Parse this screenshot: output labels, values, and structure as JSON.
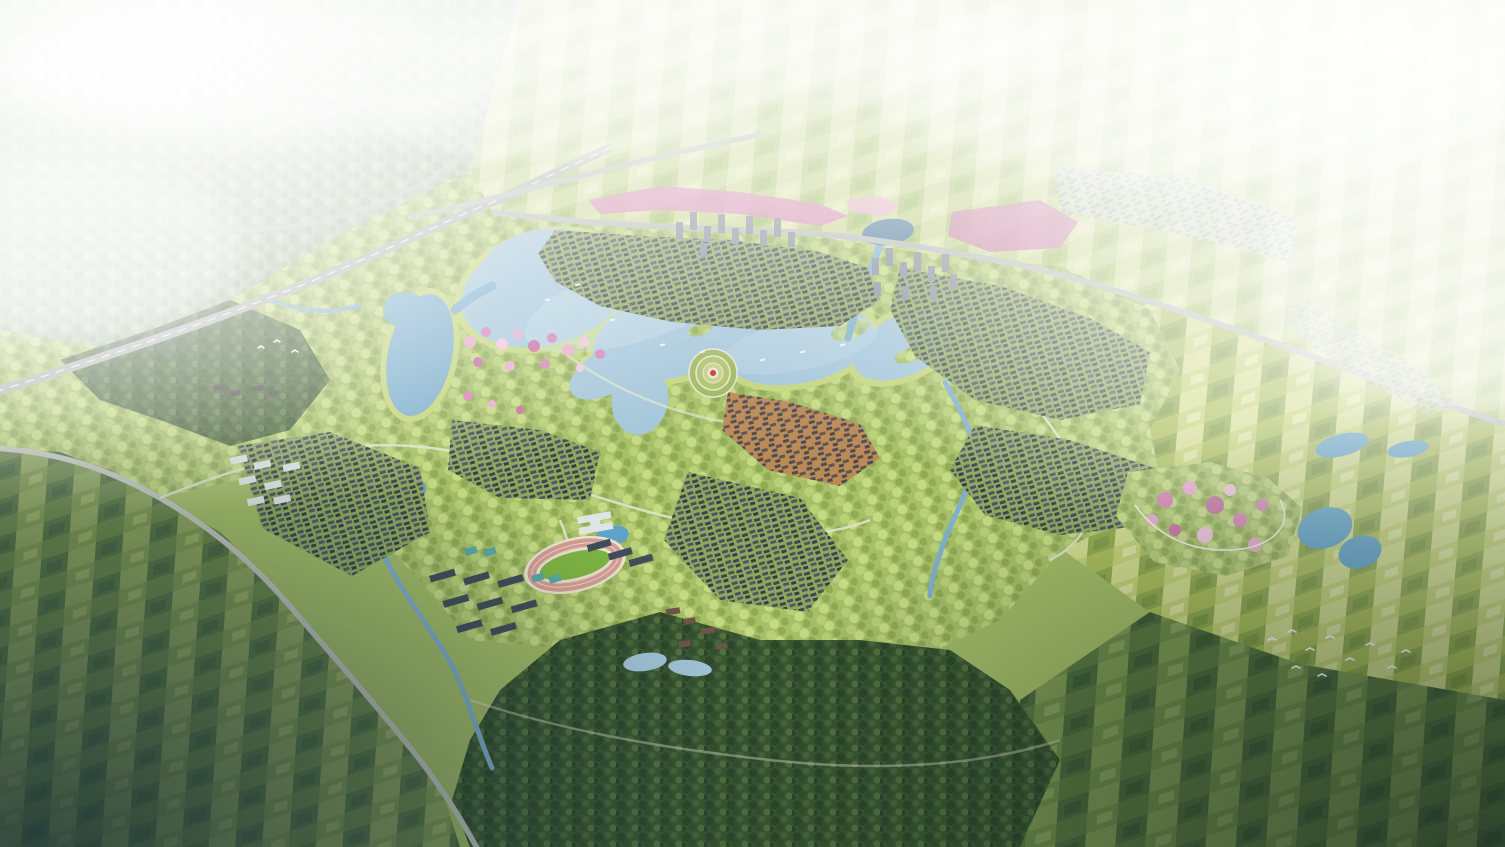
{
  "meta": {
    "description": "Photorealistic aerial bird's-eye rendering of a planned lakeside eco-town: central lake with circular plaza island, high-rise clusters on the north shore, low-rise villages, school campus with stadium, dark forest to the south, and hazy patchwork farmland all around. No text or UI elements are present in the image.",
    "width": 1505,
    "height": 847
  },
  "scene": {
    "features": [
      "misty northwest forest",
      "highway with loop-ramp interchange",
      "north boundary road",
      "western ring road",
      "central lake",
      "west lake",
      "circular plaza with red center",
      "old town quarter",
      "north lakeside town",
      "tower clusters",
      "northeast villages",
      "east villages",
      "southwest village",
      "school campus with stadium and courts",
      "resort cluster with pond",
      "southern dark forest",
      "flower park with ponds",
      "pink blossom ribbon and groves",
      "patchwork farmland",
      "streams",
      "egrets",
      "boats"
    ]
  },
  "palette": {
    "base_park": "#a2bc66",
    "park_mottle_bg": "#a6bf68",
    "park_mottle": [
      "#b8d076",
      "#90ab54",
      "#c6da83"
    ],
    "field_ne": [
      "#d6dfa2",
      "#bfd084",
      "#cbd794",
      "#abc46e",
      "#e2e7b2",
      "#9cbb62"
    ],
    "field_e": [
      "#c3d274",
      "#a9bd57",
      "#d2dd8d",
      "#8fa94c",
      "#dce49e",
      "#7f9a45"
    ],
    "field_s": [
      "#6f8c49",
      "#5a783f",
      "#7e9a52",
      "#4c6a3b",
      "#87a35c",
      "#3f5d36"
    ],
    "field_w": [
      "#7d9751",
      "#688548",
      "#8ca35c",
      "#567343",
      "#99ad62",
      "#4a6740"
    ],
    "forest_bg": "#3a5632",
    "forest_dots": [
      "#2d4729",
      "#47663a",
      "#33502d",
      "#52713f"
    ],
    "forest_light_bg": "#a8bda0",
    "forest_light_dots": [
      "#93ab8c",
      "#b9cab0",
      "#9db695"
    ],
    "village_bg": "#8fa75d",
    "village_roofs": [
      "#46525e",
      "#3a4650",
      "#4d5965",
      "#333e47"
    ],
    "village_light_bg": "#c9d2bd",
    "village_light_roof": "#98a2ab",
    "oldtown_bg": "#bb8a55",
    "oldtown_roofs": [
      "#4e4c52",
      "#5d5450",
      "#474a50"
    ],
    "water_main": "#a4c6da",
    "water_deep": "#7fafcd",
    "water_bright": "#5fa2c9",
    "water_pond_dark": "#517d9c",
    "water_highlight": "#cfe2ec",
    "shore_band": "#c4d57a",
    "road_highway": "#a9afab",
    "road_line": "#eceee9",
    "road_main": "#b6bab4",
    "road_light": "#c2c6be",
    "road_path": "#e0e4cc",
    "tower_facade": "#868c9b",
    "tower_stroke": "#565d6b",
    "white_building": "#dfe4e4",
    "white_building_stroke": "#9aa3a8",
    "campus_slab": "#3f4c59",
    "stadium_stand": "#e8e4cf",
    "track": "#d49c92",
    "pitch_green": "#7db344",
    "court_teal": "#59a8a2",
    "plaza_ring_outer": "#9fb85f",
    "plaza_ring_mid": "#aec36a",
    "plaza_ring_inner": "#c8cf86",
    "plaza_path": "#e9e6d8",
    "plaza_red": "#c03a2e",
    "blossom": [
      "#e8abcd",
      "#d583b4",
      "#c76fa4",
      "#f0c4dc"
    ],
    "resort_brown": "#6b5648",
    "temple_dark": "#4a4440",
    "mist_white": "#ffffff",
    "shade_bl": "#1f3438",
    "shade_br": "#142420",
    "bird_white": "#ffffff",
    "boat_white": "#f4f8fa"
  }
}
